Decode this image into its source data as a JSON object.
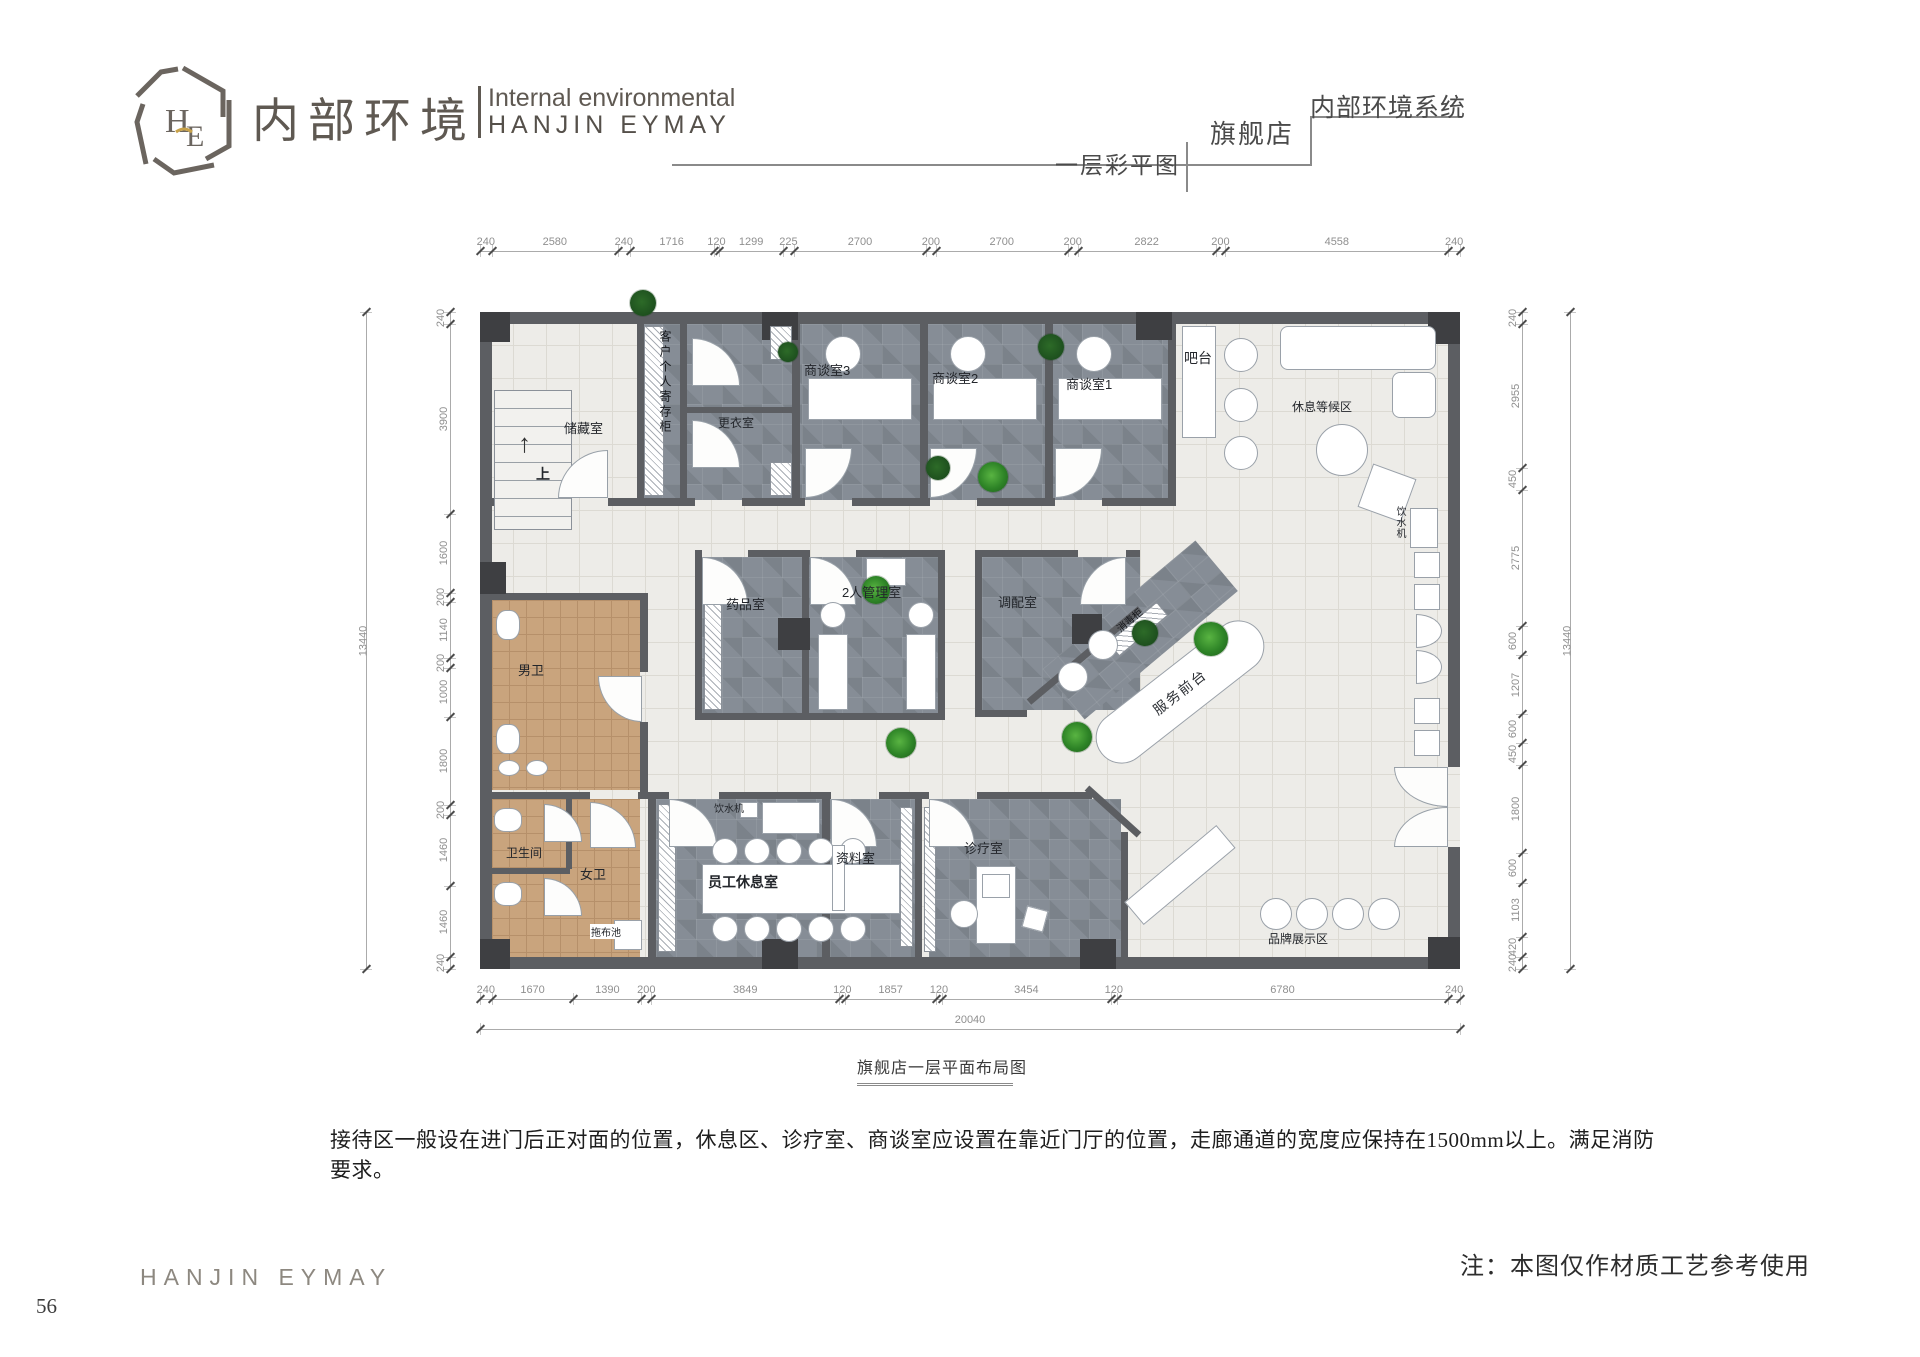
{
  "page": {
    "number": "56"
  },
  "header": {
    "logo_monogram": "HE",
    "brand_cn": "内部环境",
    "brand_en_line1": "Internal environmental",
    "brand_en_line2": "HANJIN EYMAY",
    "right_system": "内部环境系统",
    "right_store": "旗舰店",
    "right_drawing": "一层彩平图"
  },
  "plan": {
    "caption": "旗舰店一层平面布局图",
    "rooms": {
      "storage": "储藏室",
      "locker": "客户个人寄存柜",
      "changing": "更衣室",
      "meeting3": "商谈室3",
      "meeting2": "商谈室2",
      "meeting1": "商谈室1",
      "bar": "吧台",
      "waiting": "休息等候区",
      "water_right": "饮水机",
      "medicine": "药品室",
      "management": "2人管理室",
      "dispensing": "调配室",
      "disinfect": "消毒柜",
      "service_desk": "服务前台",
      "mens": "男卫",
      "toilet": "卫生间",
      "womens": "女卫",
      "mop": "拖布池",
      "staff_water": "饮水机",
      "staff": "员工休息室",
      "archive": "资料室",
      "treatment": "诊疗室",
      "display": "品牌展示区",
      "up": "上",
      "up_arrow": "↑"
    },
    "dimensions": {
      "top": [
        240,
        2580,
        240,
        1716,
        120,
        1299,
        225,
        2700,
        200,
        2700,
        200,
        2822,
        200,
        4558,
        240
      ],
      "bottom": [
        240,
        1670,
        1390,
        200,
        3849,
        120,
        1857,
        120,
        3454,
        120,
        6780,
        240
      ],
      "left": [
        240,
        3900,
        1600,
        200,
        1140,
        200,
        1000,
        1800,
        200,
        1460,
        1460,
        240
      ],
      "right": [
        240,
        2955,
        450,
        2775,
        600,
        1207,
        600,
        450,
        1800,
        600,
        1103,
        420,
        240
      ],
      "total_width": "20040",
      "total_height": "13440"
    }
  },
  "body_text": "接待区一般设在进门后正对面的位置，休息区、诊疗室、商谈室应设置在靠近门厅的位置，走廊通道的宽度应保持在1500mm以上。满足消防要求。",
  "note": "注：本图仅作材质工艺参考使用",
  "footer": {
    "brand": "HANJIN EYMAY"
  }
}
